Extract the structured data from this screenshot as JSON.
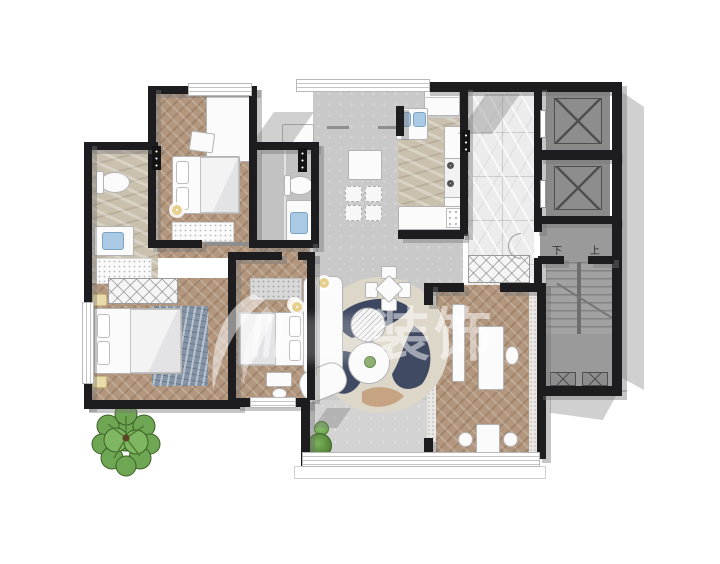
{
  "watermark": {
    "text": "装饰"
  },
  "stairs": {
    "down": "下",
    "up": "上"
  },
  "palette": {
    "wall": "#1d1d1f",
    "wall_shadow": "rgba(120,120,120,0.42)",
    "wood": "#b2977e",
    "wood_stripe": "rgba(94,62,40,0.22)",
    "living_tile": "#c9c9c9",
    "balcony_tile": "#d3d3d3",
    "bath_tile": "#c2c2c2",
    "marble_beige": "#c9c0ae",
    "marble_white": "#ececec",
    "stair_gray": "#9a9a9a",
    "shaft_gray": "#8a8a8a",
    "furniture": "#fbfbfb",
    "outline": "#b3b3b3",
    "rug_navy": "#2f3b58",
    "rug_cream": "#e3ddcf",
    "rug_tan": "#c29a76",
    "bed_rug_blue": "#8494a6",
    "sink_blue": "#a9c9e4",
    "lamp_ring": "#e7cf8e",
    "tree_green": "#6fa653",
    "tree_dark": "#4d7a33",
    "watermark_white": "rgba(255,255,255,0.5)"
  }
}
